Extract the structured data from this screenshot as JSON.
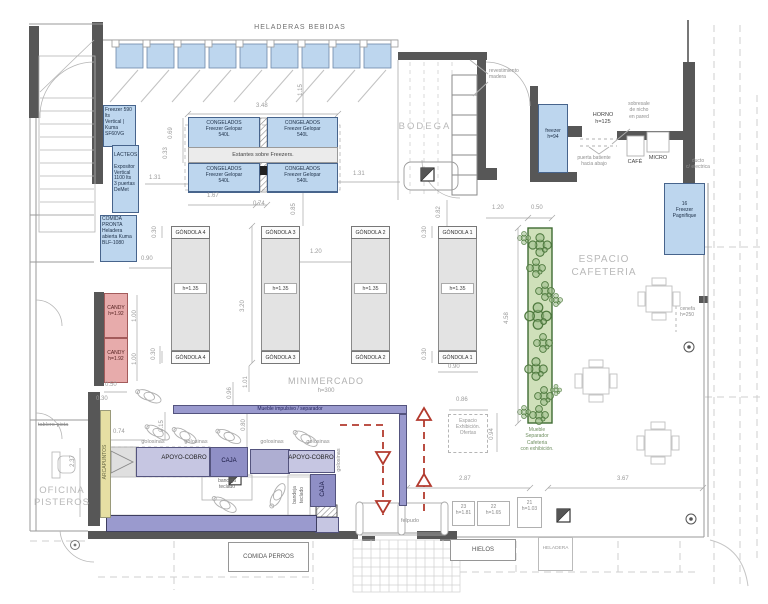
{
  "header": {
    "title": "HELADERAS  BEBIDAS"
  },
  "rooms": {
    "bodega": "BODEGA",
    "minimercado": "MINIMERCADO",
    "minimercado_height": "h=300",
    "cafeteria": "ESPACIO\nCAFETERIA",
    "oficina": "OFICINA\nPISTEROS"
  },
  "equipment": {
    "freezer_590": "Freezer 590 lts\nVertical | Kuma\nSF60VG",
    "lacteos": "LACTEOS",
    "expositor": "Expositor\nVertical\n1100 lts\n3 puertas\nDeMet",
    "comida_pronta": "COMIDA\nPRONTA\nHeladera\nabierta Kuma\nBLF-1080",
    "congelados": "CONGELADOS\nFreezer Gelopar\n540L",
    "estantes": "Estantes sobre Freezers.",
    "freezer_94": "freezer\nh=94",
    "horno": "HORNO\nh=125",
    "cafe": "CAFÉ",
    "micro": "MICRO",
    "pagnifique": "16\nFreezer\nPagnifique",
    "candy": "CANDY\nh=1.92",
    "separador_cafeteria": "Mueble\nSeparador\nCafeteria\ncon exhibición.",
    "espacio_exhibicion": "Espacio\nExhibición.\nOfertas"
  },
  "gondolas": {
    "g1": "GÓNDOLA 1",
    "g2": "GÓNDOLA 2",
    "g3": "GÓNDOLA 3",
    "g4": "GÓNDOLA 4",
    "height": "h=1.35"
  },
  "checkout": {
    "apoyo": "APOYO-COBRO",
    "caja": "CAJA",
    "bandeja": "bandeja\nteclado",
    "golosinas": "golosinas",
    "arcapuntos": "ARCAPUNTOS",
    "mueble_impulsivo": "Mueble  impulsivo  /  separador",
    "felpudo": "felpudo"
  },
  "units": {
    "u23": "23\nh=1.81",
    "u22": "22\nh=1.65",
    "u21": "21\nh=1.03"
  },
  "outside": {
    "comida_perros": "COMIDA  PERROS",
    "hielos": "HIELOS",
    "heladera": "HELADERA"
  },
  "notes": {
    "revestimiento": "revestimiento\nmadera",
    "sobresale": "sobresale\nde nicho\nen pared",
    "puerta_batiente": "puerta batiente\nhacia abajo",
    "ducto": "ducto\nc/ electrica",
    "cenefa": "cenefa\nh=250",
    "tablero": "tablero-pista"
  },
  "dims": {
    "d348": "3.48",
    "d115": "1.15",
    "d069": "0.69",
    "d033": "0.33",
    "d131": "1.31",
    "d167": "1.67",
    "d074": "0.74",
    "d085": "0.85",
    "d082": "0.82",
    "d030": "0.30",
    "d090": "0.90",
    "d320": "3.20",
    "d120": "1.20",
    "d050": "0.50",
    "d458": "4.58",
    "d094": "0.94",
    "d086": "0.86",
    "d287": "2.87",
    "d367": "3.67",
    "d237": "2.37",
    "d015": "0.15",
    "d096": "0.96",
    "d101": "1.01",
    "d080": "0.80",
    "d100": "1.00"
  },
  "colors": {
    "equipment_blue": "#bdd6ee",
    "candy_pink": "#e7abab",
    "checkout_purple": "#9a9ace",
    "plant_green": "#4f7a3f",
    "circulation_red": "#b23a2e",
    "wall_gray": "#575757"
  }
}
